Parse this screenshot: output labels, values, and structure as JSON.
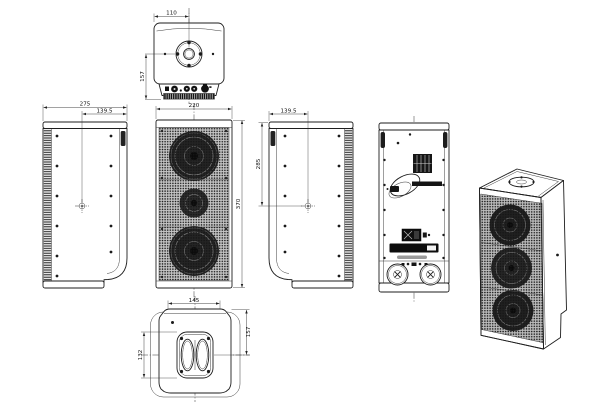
{
  "drawing": {
    "type": "technical-orthographic-drawing",
    "subject": "column loudspeaker cabinet",
    "colors": {
      "line": "#1e1e1e",
      "dimension": "#2f2f2f",
      "background": "#ffffff",
      "grille_base": "#c6c6c6",
      "grille_dot": "#161616",
      "driver_fill": "#242424"
    },
    "views": {
      "top": {
        "dim_width": "110",
        "dim_height": "157"
      },
      "side_left": {
        "dim_depth": "275",
        "dim_center_offset": "139.5"
      },
      "front": {
        "dim_width": "220",
        "dim_height": "370"
      },
      "side_right": {
        "dim_center_offset": "139.5",
        "dim_height": "285"
      },
      "rear": {},
      "isometric": {},
      "bottom": {
        "dim_width": "145",
        "dim_recess_height": "132",
        "dim_center_offset": "157"
      }
    }
  }
}
